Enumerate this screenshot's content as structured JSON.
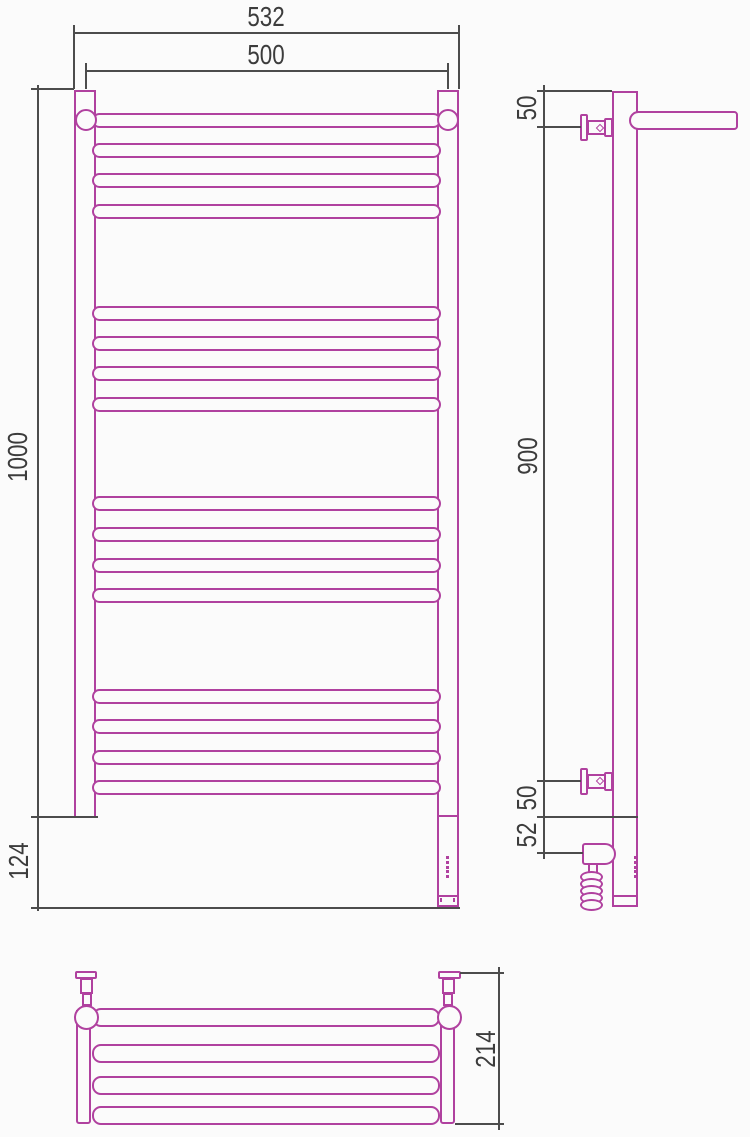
{
  "meta": {
    "type": "technical dimension drawing",
    "subject": "ladder towel rail with shelf",
    "views": [
      "front",
      "side",
      "plan"
    ]
  },
  "colors": {
    "product_line": "#b0419f",
    "dimension_line": "#4c4c4c",
    "label_text": "#3c3c3c",
    "background": "#fbfbfb"
  },
  "front_view": {
    "dims": {
      "overall_width": "532",
      "rail_width": "500",
      "height": "1000",
      "bottom_unit": "124"
    },
    "bar_rows_y": [
      113,
      143,
      173,
      204,
      306,
      336,
      366,
      397,
      496,
      527,
      558,
      588,
      689,
      719,
      750,
      780
    ]
  },
  "side_view": {
    "dims": {
      "top_bracket_offset": "50",
      "bracket_span": "900",
      "bottom_bracket_offset": "50",
      "heater_offset": "52"
    }
  },
  "plan_view": {
    "dims": {
      "depth": "214"
    },
    "bar_rows_y": [
      1008,
      1044,
      1075.5,
      1106
    ]
  }
}
